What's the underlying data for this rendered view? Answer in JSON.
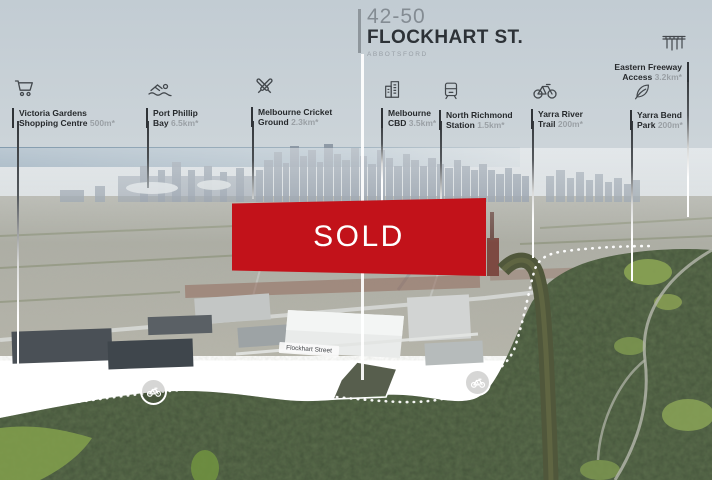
{
  "title": {
    "lot": "42-50",
    "street": "FLOCKHART ST.",
    "suburb": "ABBOTSFORD"
  },
  "banner": {
    "label": "SOLD"
  },
  "pois": [
    {
      "icon": "shopping-cart-icon",
      "line1": "Victoria Gardens",
      "line2": "Shopping Centre",
      "distance": "500m*"
    },
    {
      "icon": "swimmer-icon",
      "line1": "Port Phillip",
      "line2": "Bay",
      "distance": "6.5km*"
    },
    {
      "icon": "cricket-bats-icon",
      "line1": "Melbourne Cricket",
      "line2": "Ground",
      "distance": "2.3km*"
    },
    {
      "icon": "buildings-icon",
      "line1": "Melbourne",
      "line2": "CBD",
      "distance": "3.5km*"
    },
    {
      "icon": "train-icon",
      "line1": "North Richmond",
      "line2": "Station",
      "distance": "1.5km*"
    },
    {
      "icon": "bicycle-icon",
      "line1": "Yarra River",
      "line2": "Trail",
      "distance": "200m*"
    },
    {
      "icon": "leaf-icon",
      "line1": "Yarra Bend",
      "line2": "Park",
      "distance": "200m*"
    },
    {
      "icon": "freeway-icon",
      "line1": "Eastern Freeway",
      "line2": "Access",
      "distance": "3.2km*"
    }
  ],
  "overlays": {
    "street_sign": "Flockhart Street"
  },
  "colors": {
    "accent_red": "#c2121a",
    "label_text": "#26292c",
    "distance_text": "#9aa0a5",
    "leader_dark": "#33373b",
    "leader_light": "#ffffff"
  }
}
